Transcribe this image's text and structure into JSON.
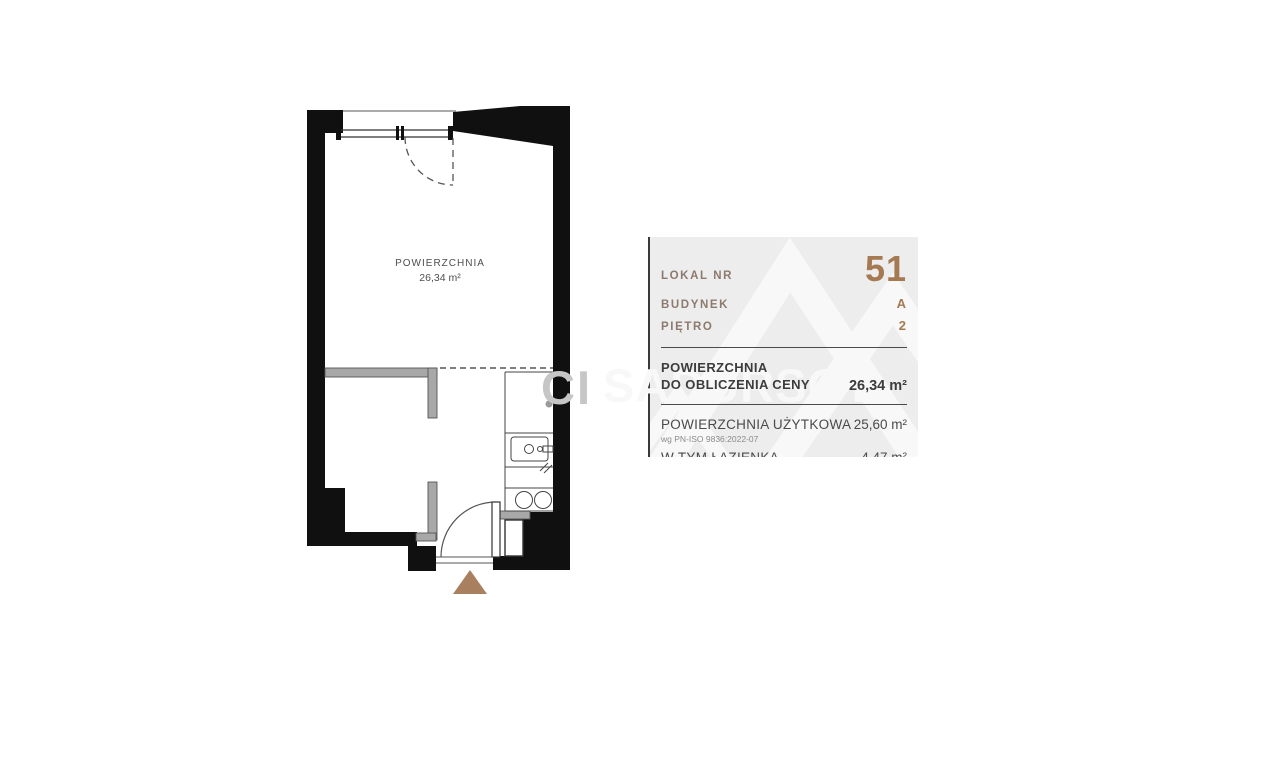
{
  "floorplan": {
    "area_label": {
      "title": "POWIERZCHNIA",
      "value": "26,34 m²"
    }
  },
  "watermark": {
    "fragment_left": "CI",
    "fragment_right": "SADURSCY"
  },
  "panel": {
    "info_rows": [
      {
        "label": "LOKAL NR",
        "value": "51"
      },
      {
        "label": "BUDYNEK",
        "value": "A"
      },
      {
        "label": "PIĘTRO",
        "value": "2"
      }
    ],
    "price_area": {
      "label_line1": "POWIERZCHNIA",
      "label_line2": "DO OBLICZENIA CENY",
      "value": "26,34 m²"
    },
    "usable_area": {
      "label": "POWIERZCHNIA UŻYTKOWA",
      "note": "wg PN-ISO 9836:2022-07",
      "value": "25,60 m²"
    },
    "bathroom_area": {
      "label": "W TYM ŁAZIENKA",
      "value": "4,47 m²"
    }
  },
  "colors": {
    "accent_brown": "#a57a52",
    "label_brown": "#8d7a6e",
    "wall_black": "#101010",
    "partition_gray": "#a8a8a8",
    "panel_bg": "#ededed",
    "entrance_arrow": "#a8805f",
    "text_dark": "#3c3c3c",
    "watermark_gray": "#c6c6c6",
    "watermark_white": "#f8f8f8"
  }
}
